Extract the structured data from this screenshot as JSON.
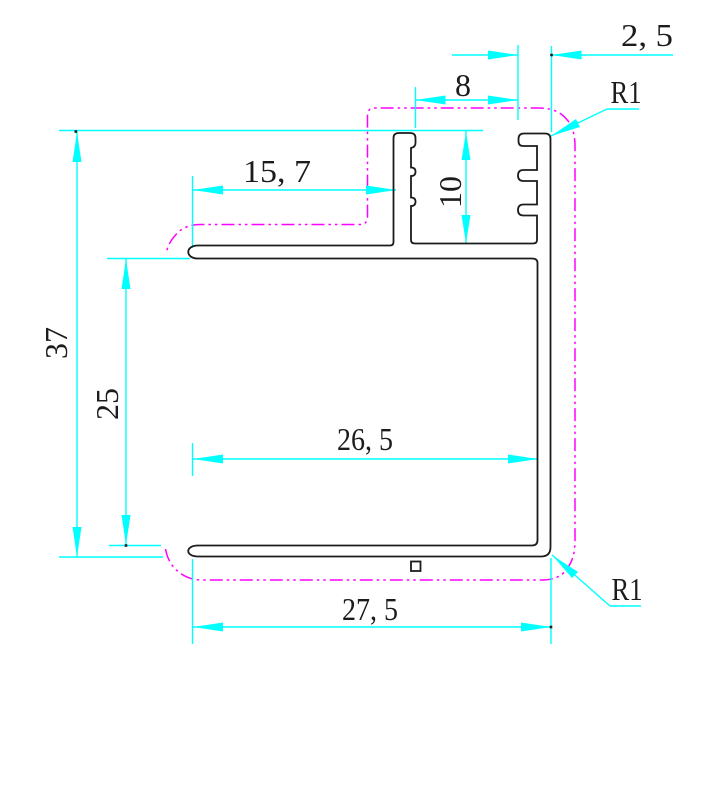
{
  "drawing": {
    "colors": {
      "dimension": "#00ffff",
      "outline": "#1c1c1c",
      "phantom": "#ff00ff",
      "background": "#ffffff"
    },
    "dimensions": {
      "overall_height": "37",
      "inner_height": "25",
      "flange_length": "15, 7",
      "channel_depth": "10",
      "channel_opening": "8",
      "top_wall_thickness": "2, 5",
      "inner_width": "26, 5",
      "overall_width": "27, 5",
      "radius_top": "R1",
      "radius_bottom": "R1"
    }
  }
}
